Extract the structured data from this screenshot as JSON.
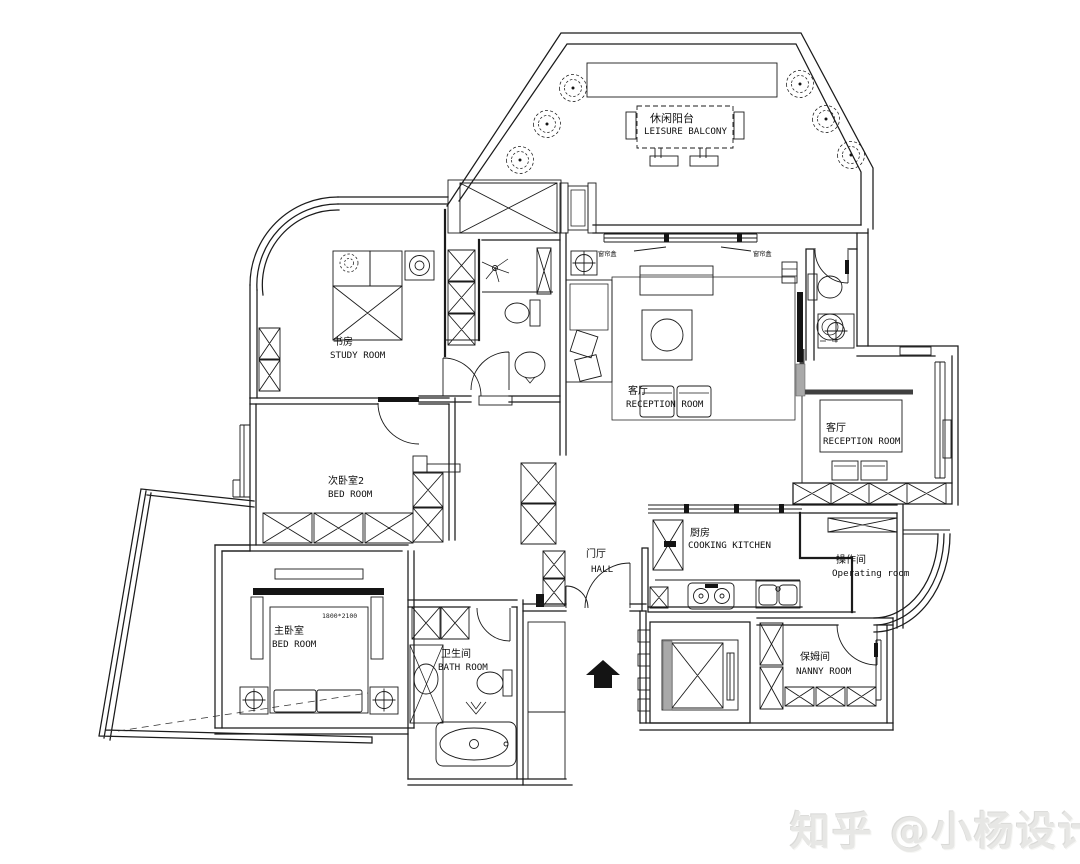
{
  "watermark": "知乎 @小杨设计",
  "rooms": {
    "balcony": {
      "zh": "休闲阳台",
      "en": "LEISURE BALCONY"
    },
    "study": {
      "zh": "书房",
      "en": "STUDY ROOM"
    },
    "bedroom2": {
      "zh": "次卧室2",
      "en": "BED ROOM"
    },
    "master_bedroom": {
      "zh": "主卧室",
      "en": "BED ROOM"
    },
    "bathroom": {
      "zh": "卫生间",
      "en": "BATH ROOM"
    },
    "living": {
      "zh": "客厅",
      "en": "RECEPTION ROOM"
    },
    "dining": {
      "zh": "客厅",
      "en": "RECEPTION ROOM"
    },
    "kitchen": {
      "zh": "厨房",
      "en": "COOKING KITCHEN"
    },
    "operating": {
      "zh": "操作间",
      "en": "Operating room"
    },
    "nanny": {
      "zh": "保姆间",
      "en": "NANNY ROOM"
    },
    "hall": {
      "zh": "门厅",
      "en": "HALL"
    }
  },
  "annotations": {
    "bed_size": "1800*2100",
    "curtain_left": "窗帘盒",
    "curtain_right": "窗帘盒"
  },
  "colors": {
    "line": "#1b1b1b",
    "background": "#ffffff",
    "watermark": "#e7e7e5"
  }
}
